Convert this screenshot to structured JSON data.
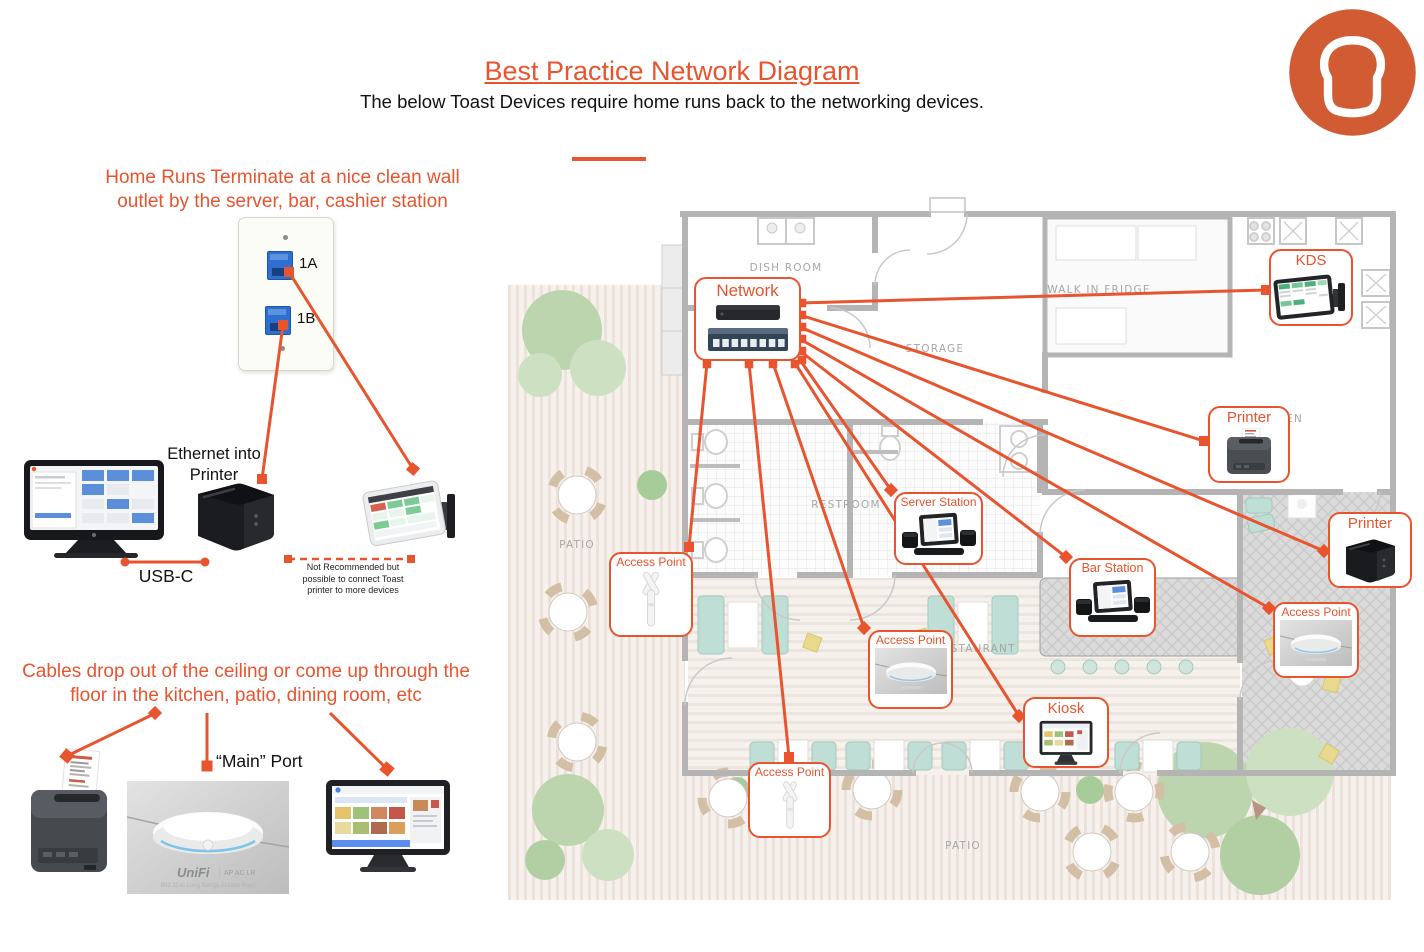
{
  "page": {
    "title": "Best Practice Network Diagram",
    "subtitle": "The below Toast Devices require home runs back to the networking devices."
  },
  "brand": {
    "logo": "toast-bread-logo",
    "accent_color": "#e8542e",
    "logo_color": "#d15b33"
  },
  "left": {
    "home_runs_note": "Home Runs Terminate at a nice clean wall outlet by the server, bar, cashier station",
    "outlet_ports": {
      "a": "1A",
      "b": "1B"
    },
    "ethernet_note": "Ethernet into Printer",
    "usb_label": "USB-C",
    "not_recommended_note": "Not Recommended but possible to connect Toast printer to more devices",
    "cables_note": "Cables drop out of the ceiling or come up through the floor in the kitchen, patio, dining room, etc",
    "main_port_label": "“Main” Port",
    "unifi": {
      "brand": "UniFi",
      "model": "AP AC LR",
      "caption": "802.11ac Long Range Access Point"
    },
    "connections": [
      {
        "from": "outlet-port-1a",
        "to": "wall-mounted-tablet"
      },
      {
        "from": "outlet-port-1b",
        "to": "toast-printer"
      },
      {
        "from": "pos-terminal",
        "to": "toast-printer",
        "label": "USB-C"
      },
      {
        "from": "toast-printer",
        "to": "wall-mounted-tablet",
        "style": "dashed"
      }
    ]
  },
  "floor_plan": {
    "labels": {
      "dish_room": "DISH ROOM",
      "walk_in_fridge": "WALK IN FRIDGE",
      "storage": "STORAGE",
      "kitchen": "KITCHEN",
      "restroom": "RESTROOM",
      "restaurant": "RESTAURANT",
      "patio_left": "PATIO",
      "patio_bottom": "PATIO"
    }
  },
  "map": {
    "callouts": [
      {
        "id": "network",
        "label": "Network",
        "device": "router-and-switch"
      },
      {
        "id": "kds",
        "label": "KDS",
        "device": "kitchen-display"
      },
      {
        "id": "printer-kitchen",
        "label": "Printer",
        "device": "impact-printer"
      },
      {
        "id": "server-station",
        "label": "Server Station",
        "device": "pos-terminal"
      },
      {
        "id": "access-point-left",
        "label": "Access Point",
        "device": "outdoor-antenna"
      },
      {
        "id": "bar-station",
        "label": "Bar Station",
        "device": "pos-terminal"
      },
      {
        "id": "access-point-mid",
        "label": "Access Point",
        "device": "ceiling-access-point"
      },
      {
        "id": "kiosk",
        "label": "Kiosk",
        "device": "kiosk-screen"
      },
      {
        "id": "printer-right",
        "label": "Printer",
        "device": "toast-cube-printer"
      },
      {
        "id": "access-point-right",
        "label": "Access Point",
        "device": "ceiling-access-point"
      },
      {
        "id": "access-point-bottom",
        "label": "Access Point",
        "device": "outdoor-antenna"
      }
    ],
    "connections": [
      {
        "from": "network",
        "to": "kds"
      },
      {
        "from": "network",
        "to": "printer-kitchen"
      },
      {
        "from": "network",
        "to": "printer-right"
      },
      {
        "from": "network",
        "to": "access-point-right"
      },
      {
        "from": "network",
        "to": "bar-station"
      },
      {
        "from": "network",
        "to": "server-station"
      },
      {
        "from": "network",
        "to": "kiosk"
      },
      {
        "from": "network",
        "to": "access-point-mid"
      },
      {
        "from": "network",
        "to": "access-point-bottom"
      },
      {
        "from": "network",
        "to": "access-point-left"
      }
    ]
  }
}
